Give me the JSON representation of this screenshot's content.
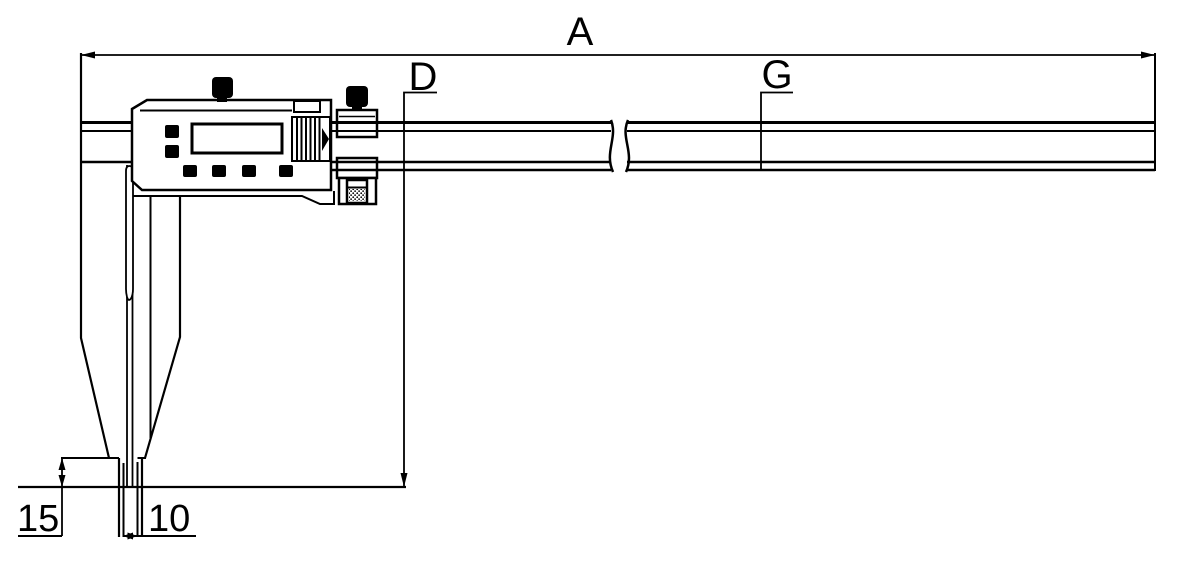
{
  "window": {
    "background_color": "#ffffff",
    "line_color": "#000000"
  },
  "figure": {
    "kind": "technical-outline-drawing",
    "subject": "long-jaw digital caliper with dimension callouts",
    "dimension_labels": {
      "overall_length": "A",
      "jaw_depth": "D",
      "beam": "G",
      "tip_height": "15",
      "tip_width": "10"
    }
  }
}
